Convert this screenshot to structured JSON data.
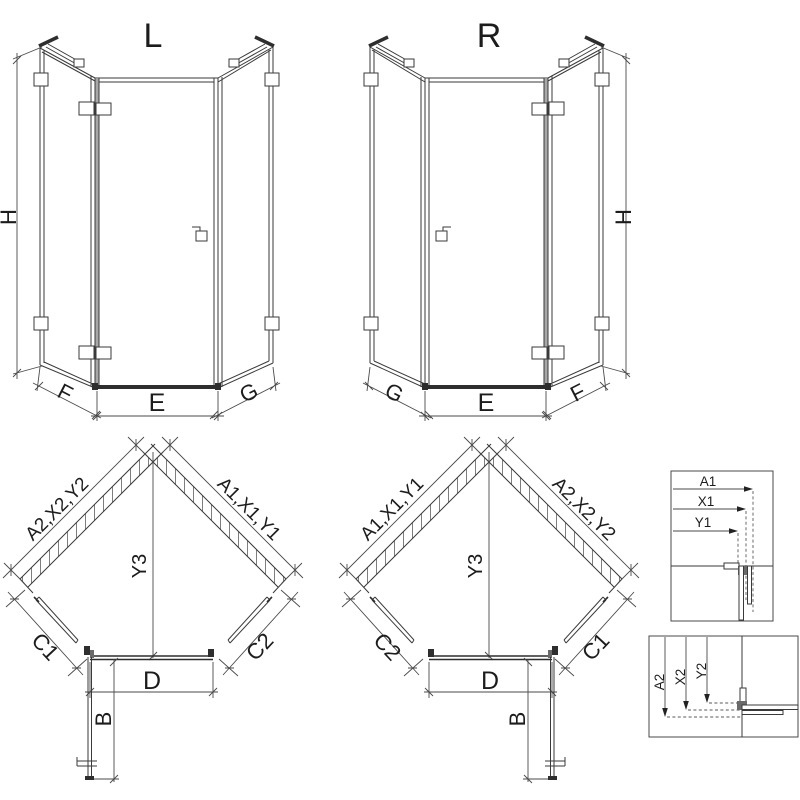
{
  "diagram": {
    "elevation_left": {
      "title": "L",
      "dim_height": "H",
      "dim_left_panel": "F",
      "dim_door": "E",
      "dim_right_panel": "G"
    },
    "elevation_right": {
      "title": "R",
      "dim_height": "H",
      "dim_left_panel": "G",
      "dim_door": "E",
      "dim_right_panel": "F"
    },
    "plan_left": {
      "wall_upper_left": "A2,X2,Y2",
      "wall_upper_right": "A1,X1,Y1",
      "dim_depth": "Y3",
      "dim_lower_left": "C1",
      "dim_lower_right": "C2",
      "dim_entry": "D",
      "dim_door_open": "B"
    },
    "plan_right": {
      "wall_upper_left": "A1,X1,Y1",
      "wall_upper_right": "A2,X2,Y2",
      "dim_depth": "Y3",
      "dim_lower_left": "C2",
      "dim_lower_right": "C1",
      "dim_entry": "D",
      "dim_door_open": "B"
    },
    "detail_wall_profile_horizontal": {
      "labels": [
        "A1",
        "X1",
        "Y1"
      ]
    },
    "detail_wall_profile_vertical": {
      "labels": [
        "A2",
        "X2",
        "Y2"
      ]
    },
    "colors": {
      "line": "#3a3a3a",
      "dark": "#2e2e2e",
      "profile_gray": "#a8a8a8",
      "hatch": "#6f6f6f",
      "background": "#ffffff"
    }
  }
}
